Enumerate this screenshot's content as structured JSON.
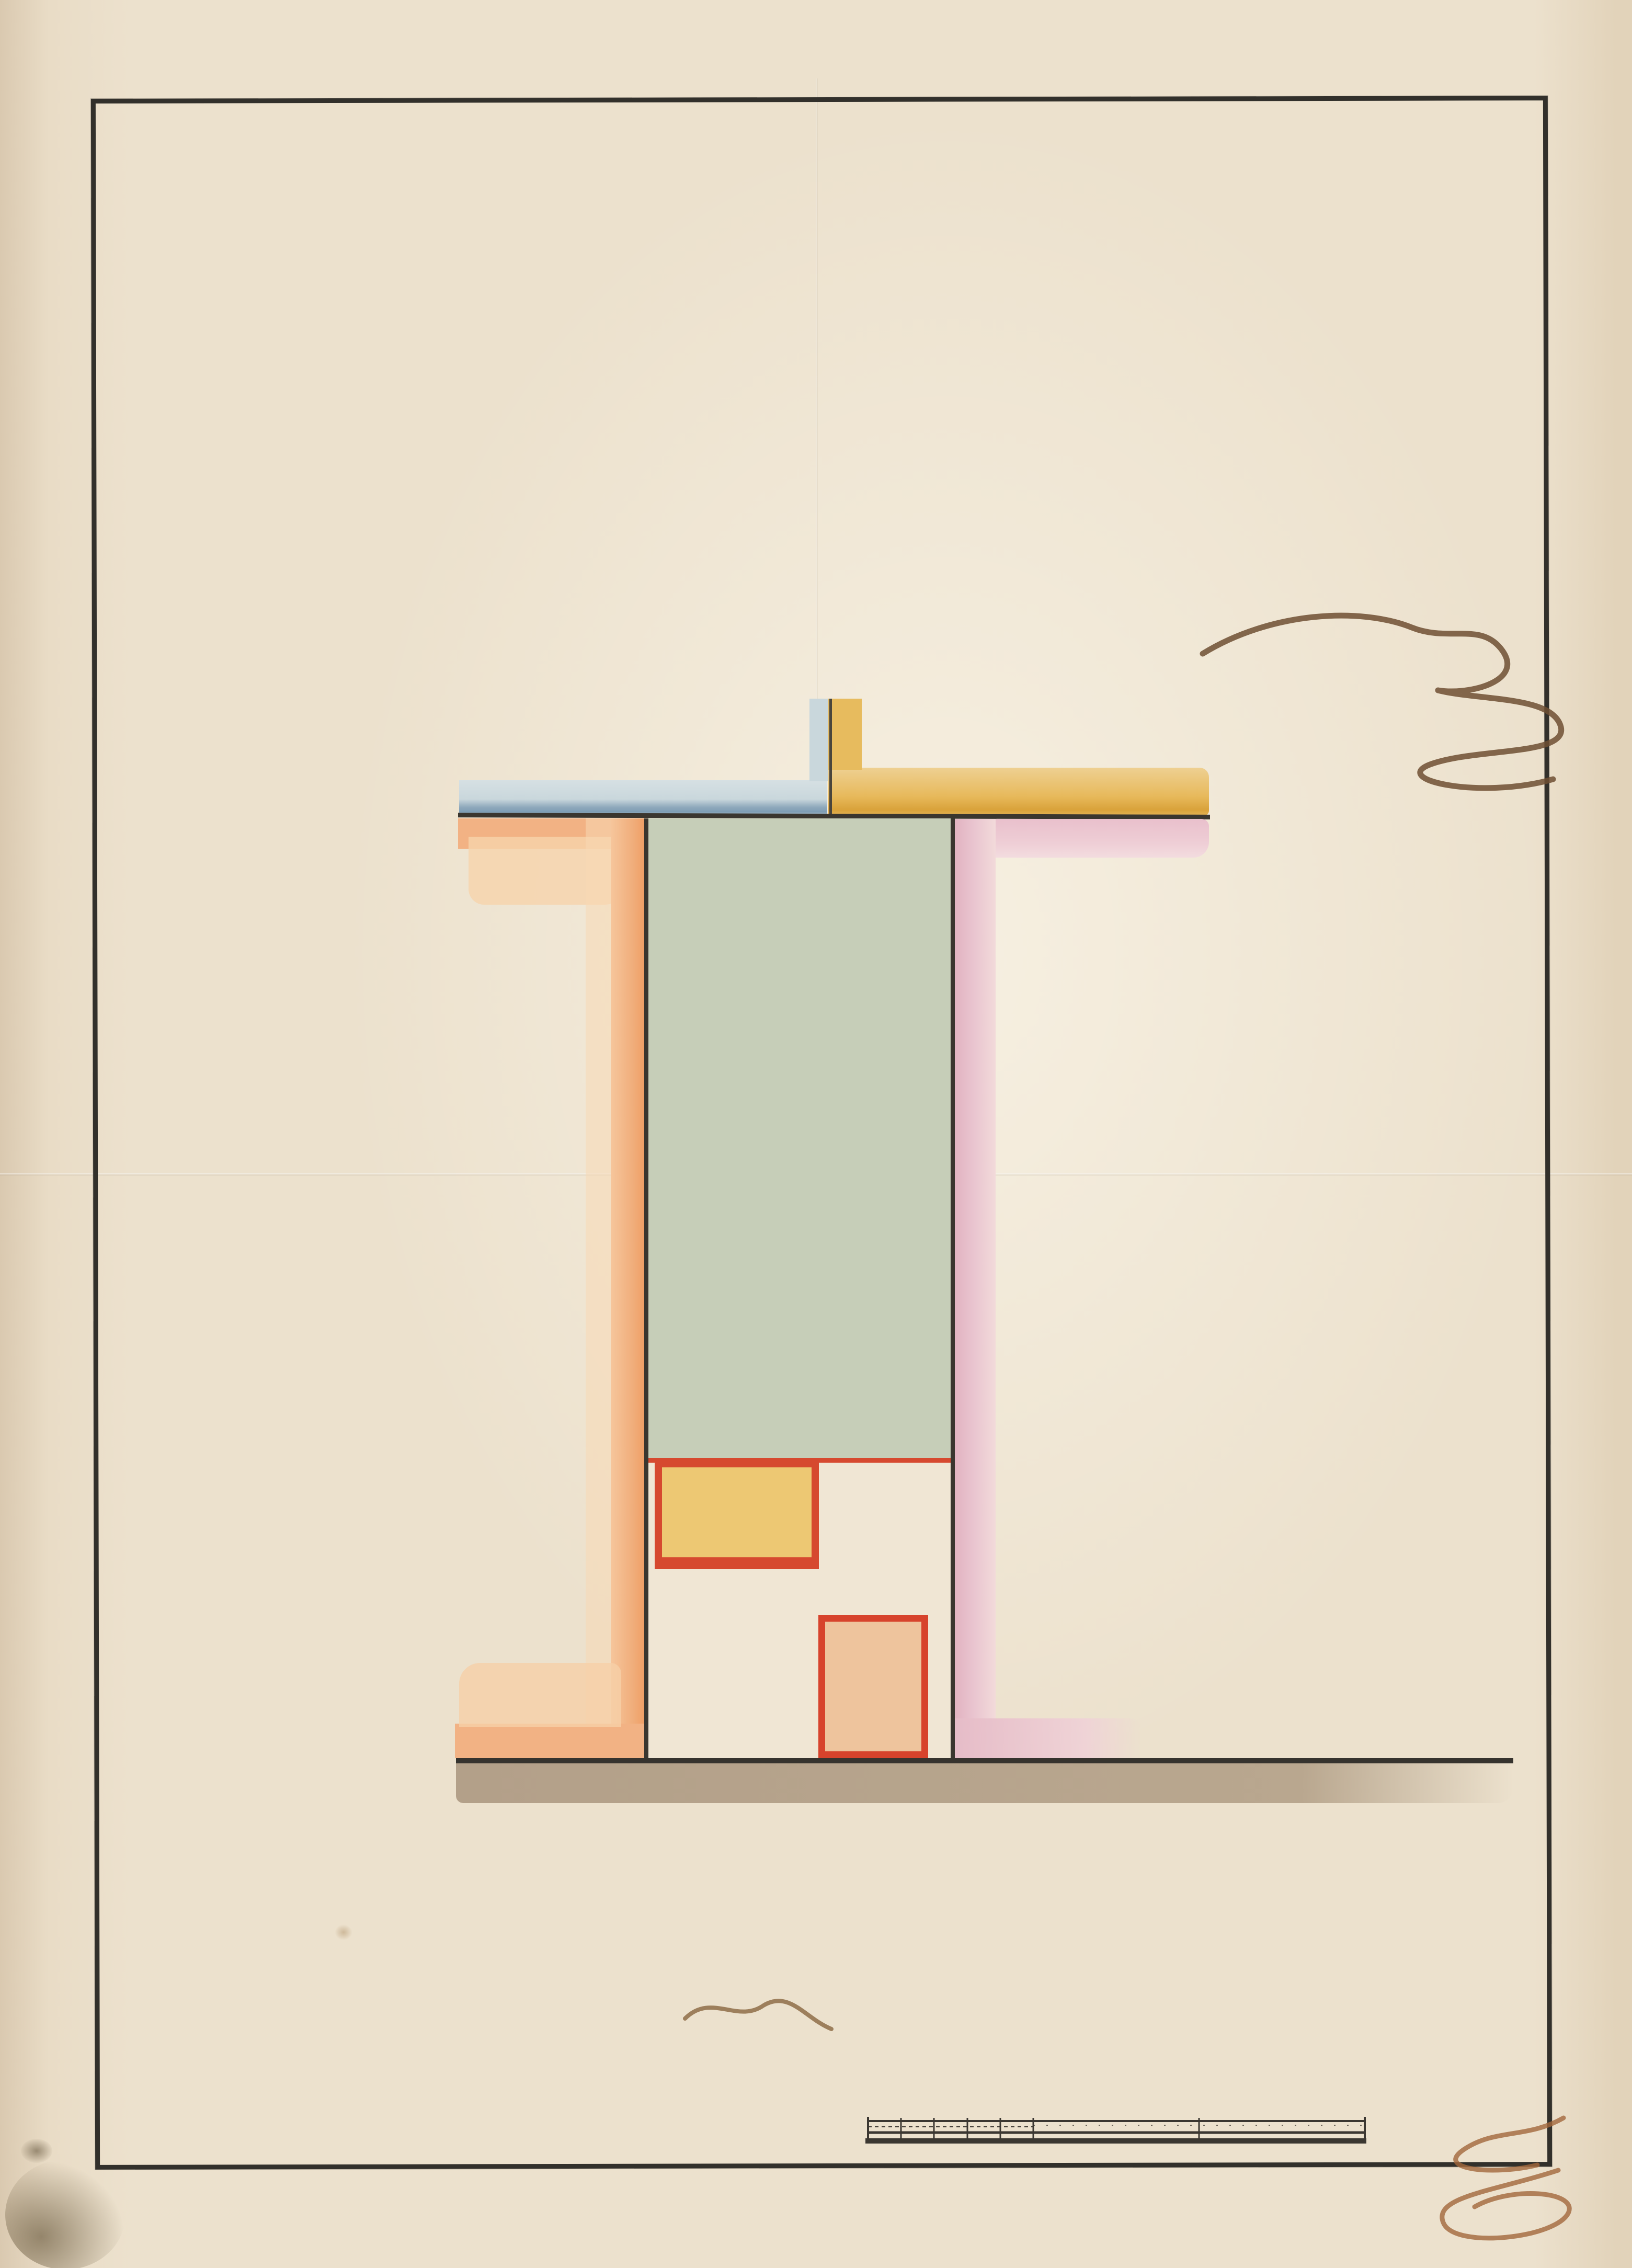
{
  "page_number": "1",
  "doc_number": "№4",
  "title_lines": [
    "Планъ пустопорожнему мѣсту состоящему въ Плоской",
    "Города Кіева Части по Іорданской Улицѣ, просимо-",
    "му Кіевскою Мѣщанкою Ксеніею Коробчевскою",
    "подъ постройку деревяннаго №3. дому — въ семъ",
    "мѣстѣ заключается 300 квадратныхъ саженъ",
    "Составленъ 28 Августа 1839 года. Кіевскій Городовъ",
    "Землемѣръ. Титулярный Совѣтникъ Шмигельскій"
  ],
  "plan": {
    "neighbor_top_left": "пустопорожнее",
    "neighbor_top_right_line1": "мѣсто Маіора",
    "neighbor_top_right_line2": "Бугакова",
    "neighbor_left_vertical": "Мѣсто пустопорожнее.",
    "neighbor_right_vertical": "Мѣсто просимое Вишневскимъ",
    "dim_top": "10",
    "dim_left": "30",
    "dim_right": "20",
    "shed_label": "Сарай",
    "house_label": "домъ",
    "street_label": "Улица Іорданская"
  },
  "scale_bar": {
    "label": "Масштабъ",
    "small_ticks": "1. 2. 3. 4. 5",
    "tick_10": "10",
    "tick_15": "15",
    "unit": "Саж."
  },
  "colors": {
    "paper": "#ece1cd",
    "frame_ink": "#32302b",
    "text_ink": "#7a573a",
    "number_ink": "#7b2f50",
    "garden_green": "#c6ceb8",
    "bush_green": "#95a571",
    "bush_shadow": "#57644a",
    "red_outline": "#d6492f",
    "shed_fill": "#edc873",
    "house_fill": "#eec49d",
    "orange_band": "#f2b284",
    "pink_band": "#e6bcc8",
    "blue_band": "#c9d7dc",
    "blue_edge": "#7e9db4",
    "yellow_band": "#e7b95b",
    "street_wash": "#b5a28c"
  }
}
